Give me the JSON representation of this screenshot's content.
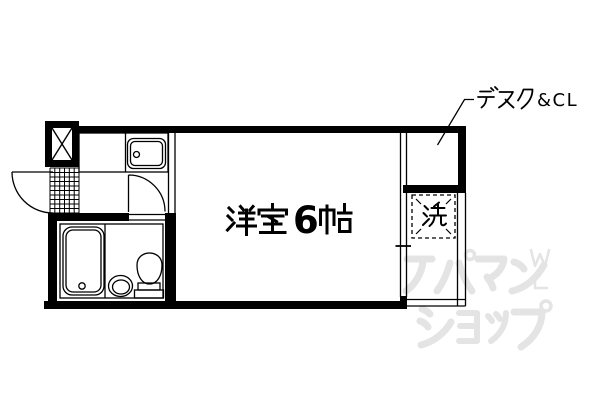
{
  "floor_plan": {
    "room_label": "洋室6帖",
    "room_label_digit": "6",
    "desk_closet_label": "デスク＆ＣＬ",
    "desk_closet_label_latin": "&CL",
    "washer_label": "洗",
    "watermark": {
      "line1": "アパマン",
      "line2": "ショップ",
      "mark_top": "W",
      "mark_bottom": "L",
      "color": "#e4e4e4"
    },
    "colors": {
      "ink": "#000000",
      "background": "#ffffff"
    },
    "fixtures": [
      "kitchen-sink",
      "bathtub",
      "wash-basin",
      "toilet",
      "washing-machine-space",
      "entrance-tile-grid",
      "service-shaft",
      "entrance-door",
      "bathroom-door",
      "desk-closet-nook",
      "window-line"
    ]
  }
}
